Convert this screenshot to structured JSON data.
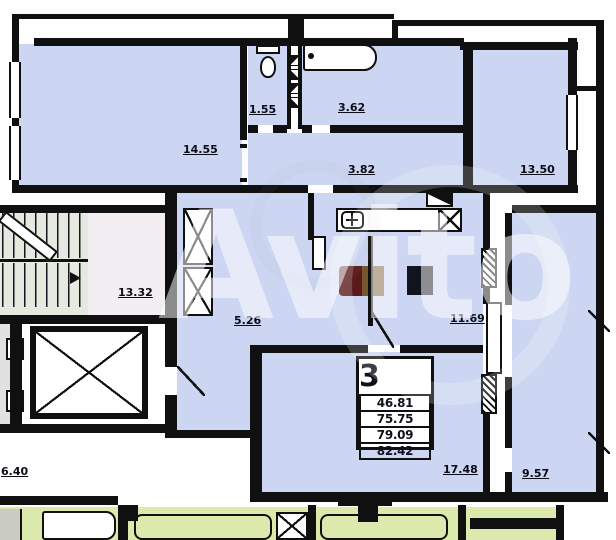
{
  "watermark_text": "Avito",
  "floorplan": {
    "labels": {
      "room_top_left": "14.55",
      "wc": "1.55",
      "bathroom": "3.62",
      "corridor": "3.82",
      "room_top_right": "13.50",
      "stairwell": "13.32",
      "hallway": "5.26",
      "kitchen_living": "11.69",
      "room_bottom": "17.48",
      "loggia": "9.57",
      "neighbor_area": "6.40"
    },
    "info_table": {
      "rooms_count": "3",
      "areas": [
        "46.81",
        "75.75",
        "79.09",
        "82.42"
      ]
    },
    "colors": {
      "apartment_fill": "#ccd6f2",
      "neighbor_fill": "#dce9ad",
      "wall": "#101010",
      "furniture_red": "#5c191c",
      "furniture_brown": "#77572e",
      "furniture_dark": "#0f141d"
    }
  }
}
